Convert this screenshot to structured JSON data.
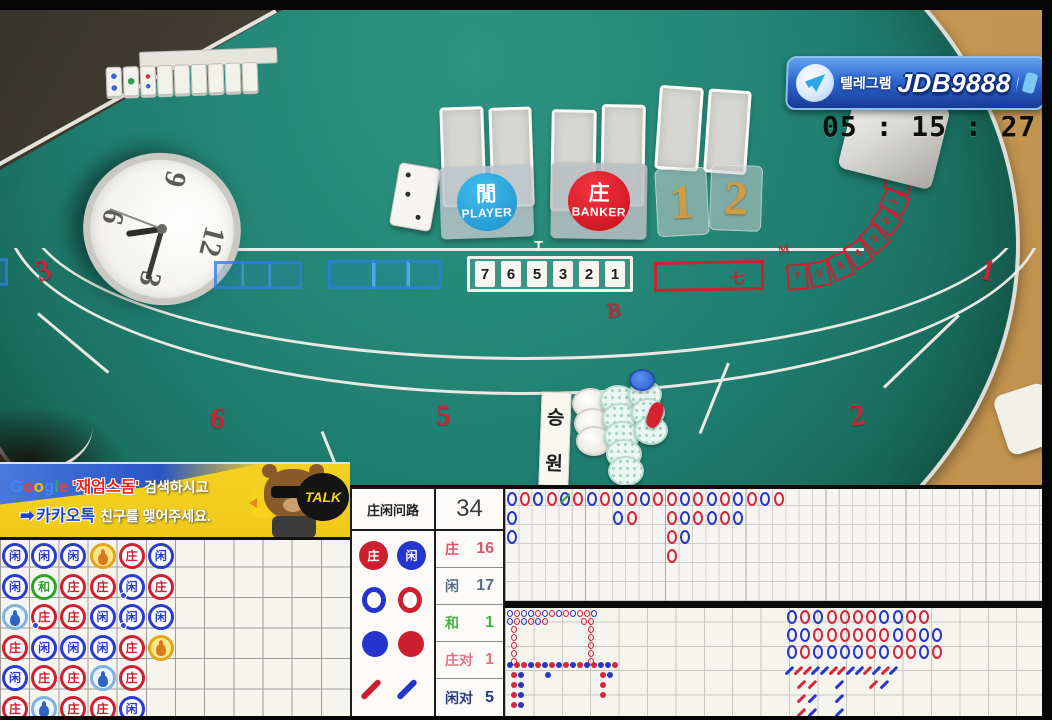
{
  "colors": {
    "banker_red": "#d5273b",
    "player_blue": "#2636c8",
    "tie_green": "#2ba32b",
    "gold": "#cf9c42"
  },
  "banner": {
    "label": "텔레그램",
    "handle": "JDB9888"
  },
  "time_display": "05 : 15 : 27 pm",
  "clock": {
    "numerals": [
      "12",
      "3",
      "6",
      "9"
    ]
  },
  "table": {
    "player": {
      "hanzi": "閒",
      "label": "PLAYER"
    },
    "banker": {
      "hanzi": "庄",
      "label": "BANKER"
    },
    "shoe_tiles": [
      "1",
      "2"
    ],
    "seat_strip": [
      "7",
      "6",
      "5",
      "3",
      "2",
      "1"
    ],
    "marker_t": "T",
    "banker_box_char": "七",
    "korean_sign": [
      "승",
      "원"
    ],
    "felt_numbers": [
      {
        "t": "3",
        "x": 36,
        "y": 256,
        "r": -18,
        "s": 30
      },
      {
        "t": "6",
        "x": 210,
        "y": 404,
        "r": 8,
        "s": 30
      },
      {
        "t": "5",
        "x": 436,
        "y": 401,
        "r": 0,
        "s": 30
      },
      {
        "t": "2",
        "x": 850,
        "y": 401,
        "r": -8,
        "s": 30
      },
      {
        "t": "1",
        "x": 980,
        "y": 256,
        "r": 14,
        "s": 30
      },
      {
        "t": "B",
        "x": 607,
        "y": 300,
        "r": -6,
        "s": 21
      },
      {
        "t": "M",
        "x": 778,
        "y": 243,
        "r": -10,
        "s": 12
      }
    ],
    "arc_seats": [
      "7",
      "6",
      "5",
      "4",
      "3",
      "2",
      "1",
      ""
    ],
    "arc_boxes": [
      {
        "x": 787,
        "y": 264,
        "r": -4
      },
      {
        "x": 809,
        "y": 261,
        "r": -13
      },
      {
        "x": 830,
        "y": 253,
        "r": -23
      },
      {
        "x": 848,
        "y": 241,
        "r": -33
      },
      {
        "x": 864,
        "y": 226,
        "r": -43
      },
      {
        "x": 876,
        "y": 208,
        "r": -53
      },
      {
        "x": 884,
        "y": 189,
        "r": -63
      },
      {
        "x": 888,
        "y": 169,
        "r": -73
      }
    ]
  },
  "ad": {
    "google": [
      "G",
      "o",
      "o",
      "g",
      "l",
      "e"
    ],
    "keyword": "'재엄스돔'",
    "line1": "검색하시고",
    "arrow": "➡",
    "kakao": "카카오톡",
    "line2": "친구를 맺어주세요.",
    "talk": "TALK"
  },
  "scoreboard": {
    "title": "庄闲问路",
    "total": "34",
    "legend": {
      "banker": "庄",
      "player": "闲"
    },
    "stats": [
      {
        "label": "庄",
        "value": "16",
        "color": "#e0556a"
      },
      {
        "label": "闲",
        "value": "17",
        "color": "#5b6b85"
      },
      {
        "label": "和",
        "value": "1",
        "color": "#43b343"
      },
      {
        "label": "庄对",
        "value": "1",
        "color": "#e27585"
      },
      {
        "label": "闲对",
        "value": "5",
        "color": "#2a3c78"
      }
    ]
  },
  "bead_plate": {
    "rows": 6,
    "cols": 12,
    "chars": {
      "P": "闲",
      "B": "庄",
      "T": "和"
    },
    "grid": [
      [
        "P",
        "P",
        "P",
        "BP",
        "B",
        "P"
      ],
      [
        "P",
        "T",
        "B",
        "B",
        "P",
        "B"
      ],
      [
        "PP",
        "B",
        "B",
        "P",
        "P",
        "P"
      ],
      [
        "B",
        "P",
        "P",
        "P",
        "B",
        "BP"
      ],
      [
        "P",
        "B",
        "B",
        "PP",
        "B",
        ""
      ],
      [
        "B",
        "PP",
        "B",
        "B",
        "P",
        ""
      ]
    ],
    "pair_dots": [
      {
        "r": 2,
        "c": 5
      },
      {
        "r": 3,
        "c": 2
      },
      {
        "r": 3,
        "c": 5
      }
    ]
  },
  "big_road": {
    "cell_w": 13.35,
    "cell_h": 19,
    "entries": [
      {
        "c": 1,
        "r": 1,
        "v": "B"
      },
      {
        "c": 2,
        "r": 1,
        "v": "R"
      },
      {
        "c": 3,
        "r": 1,
        "v": "B"
      },
      {
        "c": 4,
        "r": 1,
        "v": "R"
      },
      {
        "c": 5,
        "r": 1,
        "v": "B",
        "tie": true
      },
      {
        "c": 6,
        "r": 1,
        "v": "R"
      },
      {
        "c": 7,
        "r": 1,
        "v": "B"
      },
      {
        "c": 8,
        "r": 1,
        "v": "R"
      },
      {
        "c": 9,
        "r": 1,
        "v": "B"
      },
      {
        "c": 10,
        "r": 1,
        "v": "R"
      },
      {
        "c": 11,
        "r": 1,
        "v": "B"
      },
      {
        "c": 12,
        "r": 1,
        "v": "R"
      },
      {
        "c": 13,
        "r": 1,
        "v": "R"
      },
      {
        "c": 14,
        "r": 1,
        "v": "B"
      },
      {
        "c": 15,
        "r": 1,
        "v": "R"
      },
      {
        "c": 16,
        "r": 1,
        "v": "B"
      },
      {
        "c": 17,
        "r": 1,
        "v": "R"
      },
      {
        "c": 18,
        "r": 1,
        "v": "B"
      },
      {
        "c": 19,
        "r": 1,
        "v": "R"
      },
      {
        "c": 20,
        "r": 1,
        "v": "B"
      },
      {
        "c": 21,
        "r": 1,
        "v": "R"
      },
      {
        "c": 1,
        "r": 2,
        "v": "B"
      },
      {
        "c": 9,
        "r": 2,
        "v": "B"
      },
      {
        "c": 10,
        "r": 2,
        "v": "R"
      },
      {
        "c": 13,
        "r": 2,
        "v": "R"
      },
      {
        "c": 14,
        "r": 2,
        "v": "B"
      },
      {
        "c": 15,
        "r": 2,
        "v": "R"
      },
      {
        "c": 16,
        "r": 2,
        "v": "B"
      },
      {
        "c": 17,
        "r": 2,
        "v": "R"
      },
      {
        "c": 18,
        "r": 2,
        "v": "B"
      },
      {
        "c": 1,
        "r": 3,
        "v": "B"
      },
      {
        "c": 13,
        "r": 3,
        "v": "R"
      },
      {
        "c": 14,
        "r": 3,
        "v": "B"
      },
      {
        "c": 13,
        "r": 4,
        "v": "R"
      }
    ]
  },
  "big_eye": {
    "entries": [
      {
        "x": 0,
        "y": 0,
        "v": "B"
      },
      {
        "x": 7,
        "y": 0,
        "v": "R"
      },
      {
        "x": 14,
        "y": 0,
        "v": "B"
      },
      {
        "x": 21,
        "y": 0,
        "v": "B"
      },
      {
        "x": 28,
        "y": 0,
        "v": "R"
      },
      {
        "x": 35,
        "y": 0,
        "v": "B"
      },
      {
        "x": 42,
        "y": 0,
        "v": "R"
      },
      {
        "x": 49,
        "y": 0,
        "v": "B"
      },
      {
        "x": 56,
        "y": 0,
        "v": "R"
      },
      {
        "x": 63,
        "y": 0,
        "v": "B"
      },
      {
        "x": 70,
        "y": 0,
        "v": "R"
      },
      {
        "x": 77,
        "y": 0,
        "v": "R"
      },
      {
        "x": 84,
        "y": 0,
        "v": "B"
      },
      {
        "x": 0,
        "y": 8,
        "v": "B"
      },
      {
        "x": 7,
        "y": 8,
        "v": "R"
      },
      {
        "x": 14,
        "y": 8,
        "v": "B"
      },
      {
        "x": 21,
        "y": 8,
        "v": "R"
      },
      {
        "x": 28,
        "y": 8,
        "v": "B"
      },
      {
        "x": 35,
        "y": 8,
        "v": "R"
      },
      {
        "x": 74,
        "y": 8,
        "v": "R"
      },
      {
        "x": 81,
        "y": 8,
        "v": "R"
      },
      {
        "x": 4,
        "y": 16,
        "v": "R"
      },
      {
        "x": 4,
        "y": 24,
        "v": "R"
      },
      {
        "x": 4,
        "y": 32,
        "v": "R"
      },
      {
        "x": 4,
        "y": 40,
        "v": "R"
      },
      {
        "x": 4,
        "y": 48,
        "v": "R"
      },
      {
        "x": 81,
        "y": 16,
        "v": "R"
      },
      {
        "x": 81,
        "y": 24,
        "v": "R"
      },
      {
        "x": 81,
        "y": 32,
        "v": "R"
      },
      {
        "x": 81,
        "y": 40,
        "v": "R"
      },
      {
        "x": 81,
        "y": 48,
        "v": "R"
      }
    ]
  },
  "small_road": {
    "entries": [
      {
        "x": 0,
        "y": 0,
        "v": "B"
      },
      {
        "x": 7,
        "y": 0,
        "v": "R"
      },
      {
        "x": 14,
        "y": 0,
        "v": "R"
      },
      {
        "x": 21,
        "y": 0,
        "v": "B"
      },
      {
        "x": 28,
        "y": 0,
        "v": "R"
      },
      {
        "x": 35,
        "y": 0,
        "v": "B"
      },
      {
        "x": 42,
        "y": 0,
        "v": "R"
      },
      {
        "x": 49,
        "y": 0,
        "v": "B"
      },
      {
        "x": 56,
        "y": 0,
        "v": "R"
      },
      {
        "x": 63,
        "y": 0,
        "v": "B"
      },
      {
        "x": 70,
        "y": 0,
        "v": "R"
      },
      {
        "x": 77,
        "y": 0,
        "v": "B"
      },
      {
        "x": 84,
        "y": 0,
        "v": "R"
      },
      {
        "x": 91,
        "y": 0,
        "v": "B"
      },
      {
        "x": 98,
        "y": 0,
        "v": "B"
      },
      {
        "x": 105,
        "y": 0,
        "v": "R"
      },
      {
        "x": 4,
        "y": 10,
        "v": "R"
      },
      {
        "x": 11,
        "y": 10,
        "v": "B"
      },
      {
        "x": 38,
        "y": 10,
        "v": "B"
      },
      {
        "x": 93,
        "y": 10,
        "v": "R"
      },
      {
        "x": 100,
        "y": 10,
        "v": "B"
      },
      {
        "x": 4,
        "y": 20,
        "v": "R"
      },
      {
        "x": 11,
        "y": 20,
        "v": "B"
      },
      {
        "x": 93,
        "y": 20,
        "v": "R"
      },
      {
        "x": 4,
        "y": 30,
        "v": "R"
      },
      {
        "x": 11,
        "y": 30,
        "v": "B"
      },
      {
        "x": 93,
        "y": 30,
        "v": "R"
      },
      {
        "x": 4,
        "y": 40,
        "v": "R"
      },
      {
        "x": 11,
        "y": 40,
        "v": "B"
      }
    ]
  },
  "right_road": {
    "cell": 13.2,
    "rows": [
      [
        "B",
        "R",
        "B",
        "R",
        "R",
        "R",
        "R",
        "B",
        "B",
        "R",
        "R"
      ],
      [
        "B",
        "B",
        "R",
        "R",
        "R",
        "R",
        "R",
        "R",
        "B",
        "R",
        "B",
        "B"
      ],
      [
        "B",
        "R",
        "B",
        "B",
        "B",
        "B",
        "R",
        "B",
        "R",
        "R",
        "B",
        "R"
      ]
    ]
  },
  "cockroach": {
    "entries": [
      {
        "x": 0,
        "y": 0,
        "v": "B"
      },
      {
        "x": 9,
        "y": 0,
        "v": "R"
      },
      {
        "x": 18,
        "y": 0,
        "v": "R"
      },
      {
        "x": 26,
        "y": 0,
        "v": "B"
      },
      {
        "x": 35,
        "y": 0,
        "v": "B"
      },
      {
        "x": 44,
        "y": 0,
        "v": "R"
      },
      {
        "x": 52,
        "y": 0,
        "v": "R"
      },
      {
        "x": 61,
        "y": 0,
        "v": "B"
      },
      {
        "x": 70,
        "y": 0,
        "v": "B"
      },
      {
        "x": 78,
        "y": 0,
        "v": "R"
      },
      {
        "x": 87,
        "y": 0,
        "v": "B"
      },
      {
        "x": 96,
        "y": 0,
        "v": "R"
      },
      {
        "x": 104,
        "y": 0,
        "v": "B"
      },
      {
        "x": 12,
        "y": 14,
        "v": "R"
      },
      {
        "x": 23,
        "y": 14,
        "v": "R"
      },
      {
        "x": 50,
        "y": 14,
        "v": "B"
      },
      {
        "x": 84,
        "y": 14,
        "v": "R"
      },
      {
        "x": 95,
        "y": 14,
        "v": "B"
      },
      {
        "x": 12,
        "y": 28,
        "v": "R"
      },
      {
        "x": 23,
        "y": 28,
        "v": "B"
      },
      {
        "x": 50,
        "y": 28,
        "v": "B"
      },
      {
        "x": 12,
        "y": 42,
        "v": "R"
      },
      {
        "x": 23,
        "y": 42,
        "v": "B"
      },
      {
        "x": 50,
        "y": 42,
        "v": "B"
      }
    ]
  }
}
